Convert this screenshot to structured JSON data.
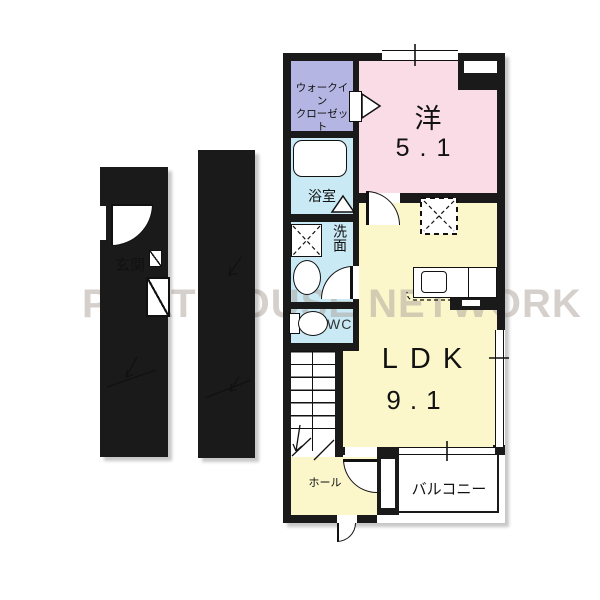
{
  "watermark": {
    "text": "PITAT HOUSE NETWORK"
  },
  "unit": {
    "rooms": {
      "walk_in_closet": {
        "label_line1": "ウォークイン",
        "label_line2": "クローゼット"
      },
      "western_room": {
        "label": "洋",
        "size": "5.1"
      },
      "bathroom": {
        "label": "浴室"
      },
      "washroom": {
        "label": "洗面"
      },
      "toilet": {
        "label": "WC"
      },
      "ldk": {
        "label": "LDK",
        "size": "9.1"
      },
      "hall": {
        "label": "ホール"
      },
      "balcony": {
        "label": "バルコニー"
      }
    }
  },
  "entrance_tower": {
    "genkan_label": "玄関"
  },
  "colors": {
    "wall": "#1a1a1a",
    "western_room": "#f9dce6",
    "closet": "#b5b5e3",
    "wet_area": "#c9e9f5",
    "ldk": "#fbf7cb",
    "genkan": "#b3b3b3",
    "stair_landing": "#f9e8dd"
  }
}
